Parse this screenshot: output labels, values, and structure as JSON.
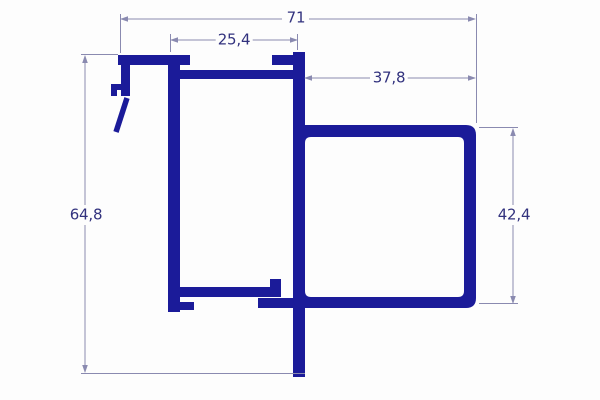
{
  "drawing": {
    "type": "aluminium-profile-cross-section",
    "dimension_labels": {
      "overall_width": "71",
      "top_channel_width": "25,4",
      "right_tube_width": "37,8",
      "overall_height": "64,8",
      "right_tube_height": "42,4"
    },
    "dimension_values": {
      "overall_width": 71,
      "top_channel_width": 25.4,
      "right_tube_width": 37.8,
      "overall_height": 64.8,
      "right_tube_height": 42.4
    }
  },
  "colors": {
    "profile": "#1b1b99",
    "dimension_line": "#8a8ab0",
    "dimension_text": "#32327e",
    "background": "#fdfdfd"
  }
}
